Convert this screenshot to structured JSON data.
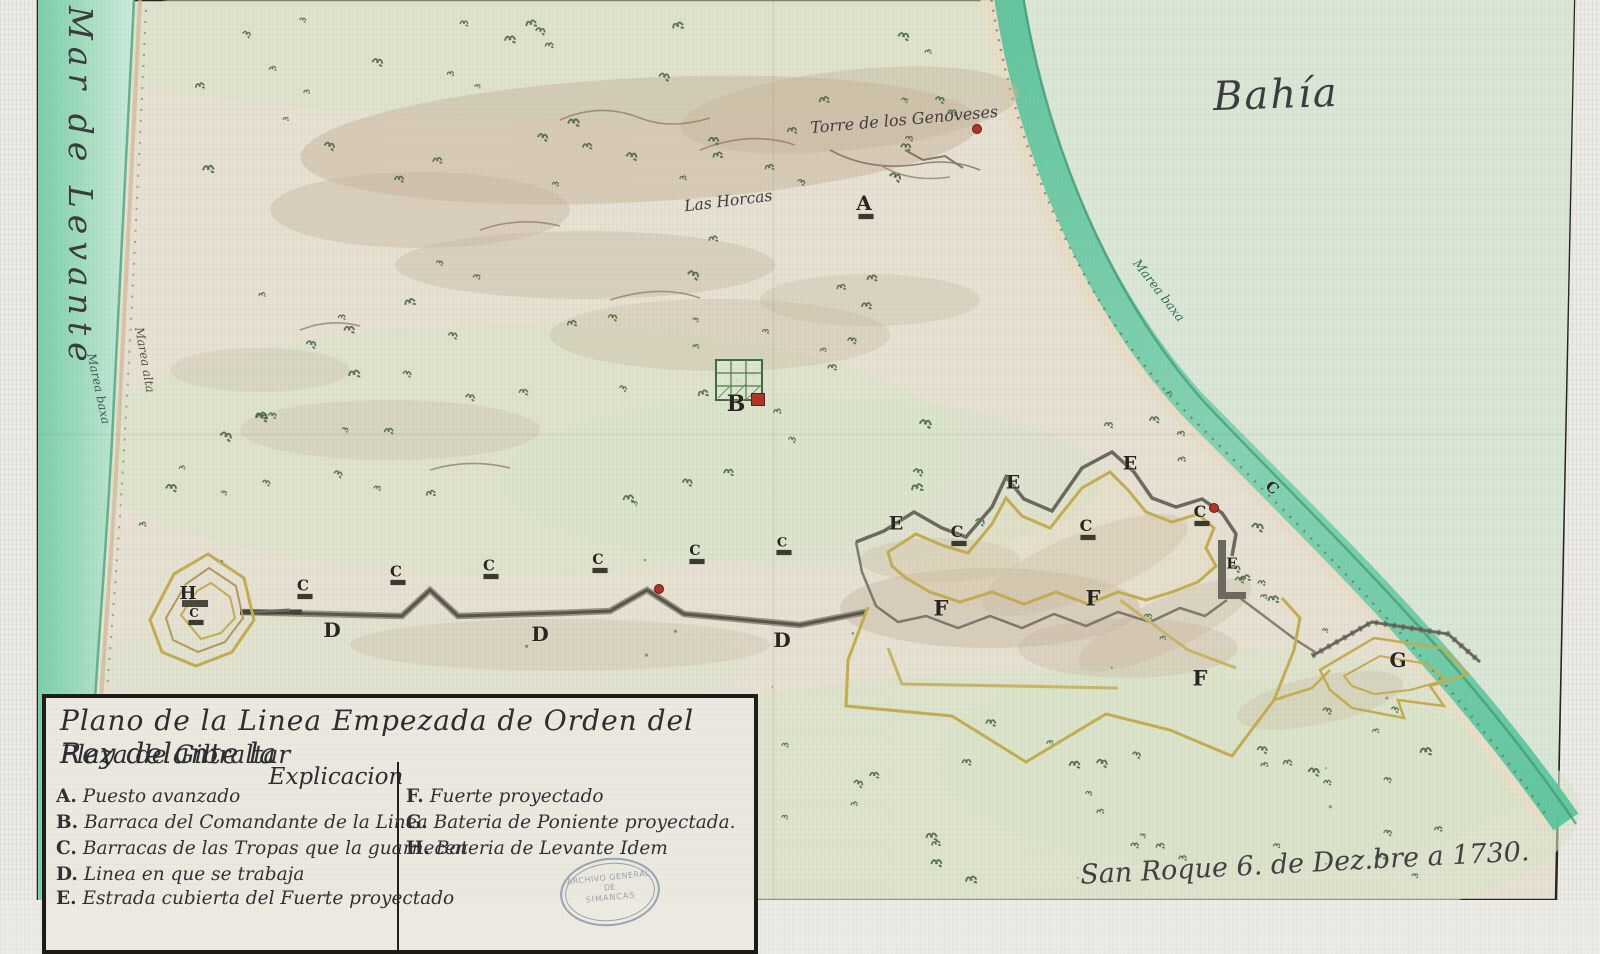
{
  "labels": {
    "sea_left": "Mar de Levante",
    "bay": "Bahía",
    "tower": "Torre de los Genoveses",
    "horcas": "Las Horcas",
    "shore_left_water": "Marea baxa",
    "shore_left_sand": "Marea alta",
    "shore_right": "Marea baxa",
    "signature": "San Roque 6. de Dez.bre a 1730."
  },
  "title_block": {
    "title_line1": "Plano de la Linea Empezada de Orden del Rey delante la",
    "title_line2": "Plaza de Gibraltar",
    "heading": "Explicacion",
    "entries_left": [
      {
        "key": "A.",
        "text": "Puesto avanzado"
      },
      {
        "key": "B.",
        "text": "Barraca del Comandante de la Linea"
      },
      {
        "key": "C.",
        "text": "Barracas de las Tropas que la guarnecen"
      },
      {
        "key": "D.",
        "text": "Linea en que se trabaja"
      },
      {
        "key": "E.",
        "text": "Estrada cubierta del Fuerte proyectado"
      }
    ],
    "entries_right": [
      {
        "key": "F.",
        "text": "Fuerte proyectado"
      },
      {
        "key": "G.",
        "text": "Bateria de Poniente proyectada."
      },
      {
        "key": "H.",
        "text": "Bateria de Levante Idem"
      }
    ]
  },
  "stamp": {
    "line1": "ARCHIVO GENERAL",
    "line2": "DE",
    "line3": "SIMANCAS"
  },
  "markers": [
    {
      "letter": "A",
      "x": 864,
      "y": 203,
      "size": 20,
      "bar": true
    },
    {
      "letter": "B",
      "x": 736,
      "y": 404,
      "size": 22
    },
    {
      "letter": "C",
      "x": 303,
      "y": 586,
      "size": 15,
      "bar": true
    },
    {
      "letter": "C",
      "x": 396,
      "y": 572,
      "size": 15,
      "bar": true
    },
    {
      "letter": "C",
      "x": 489,
      "y": 566,
      "size": 15,
      "bar": true
    },
    {
      "letter": "C",
      "x": 598,
      "y": 560,
      "size": 14,
      "bar": true
    },
    {
      "letter": "C",
      "x": 695,
      "y": 551,
      "size": 14,
      "bar": true
    },
    {
      "letter": "C",
      "x": 782,
      "y": 543,
      "size": 13,
      "bar": true
    },
    {
      "letter": "C",
      "x": 957,
      "y": 532,
      "size": 16,
      "bar": true
    },
    {
      "letter": "C",
      "x": 1086,
      "y": 526,
      "size": 16,
      "bar": true
    },
    {
      "letter": "C",
      "x": 1200,
      "y": 512,
      "size": 16,
      "bar": true
    },
    {
      "letter": "C",
      "x": 1272,
      "y": 488,
      "size": 15,
      "rot": 42
    },
    {
      "letter": "D",
      "x": 332,
      "y": 630,
      "size": 20
    },
    {
      "letter": "D",
      "x": 540,
      "y": 634,
      "size": 20
    },
    {
      "letter": "D",
      "x": 782,
      "y": 640,
      "size": 20
    },
    {
      "letter": "E",
      "x": 896,
      "y": 524,
      "size": 19
    },
    {
      "letter": "E",
      "x": 1013,
      "y": 483,
      "size": 19
    },
    {
      "letter": "E",
      "x": 1130,
      "y": 464,
      "size": 19
    },
    {
      "letter": "E",
      "x": 1232,
      "y": 564,
      "size": 15
    },
    {
      "letter": "F",
      "x": 941,
      "y": 608,
      "size": 21
    },
    {
      "letter": "F",
      "x": 1093,
      "y": 598,
      "size": 21
    },
    {
      "letter": "F",
      "x": 1200,
      "y": 678,
      "size": 21
    },
    {
      "letter": "G",
      "x": 1398,
      "y": 660,
      "size": 20
    },
    {
      "letter": "H",
      "x": 188,
      "y": 594,
      "size": 18
    },
    {
      "letter": "C",
      "x": 194,
      "y": 613,
      "size": 12,
      "bar": true
    }
  ],
  "red_marks": [
    {
      "x": 976,
      "y": 128,
      "shape": "dot"
    },
    {
      "x": 658,
      "y": 588,
      "shape": "dot"
    },
    {
      "x": 1213,
      "y": 507,
      "shape": "dot"
    },
    {
      "x": 757,
      "y": 398,
      "shape": "square"
    }
  ],
  "colors": {
    "paper": "#e6e1d3",
    "bay": "#dae7d6",
    "sea": "#7ccfa8",
    "surf": "#5ec79e",
    "fort_gray": "#6b6860",
    "fort_yellow": "#c3ad50",
    "ink": "#2f2e34",
    "accent_red": "#b23324"
  }
}
